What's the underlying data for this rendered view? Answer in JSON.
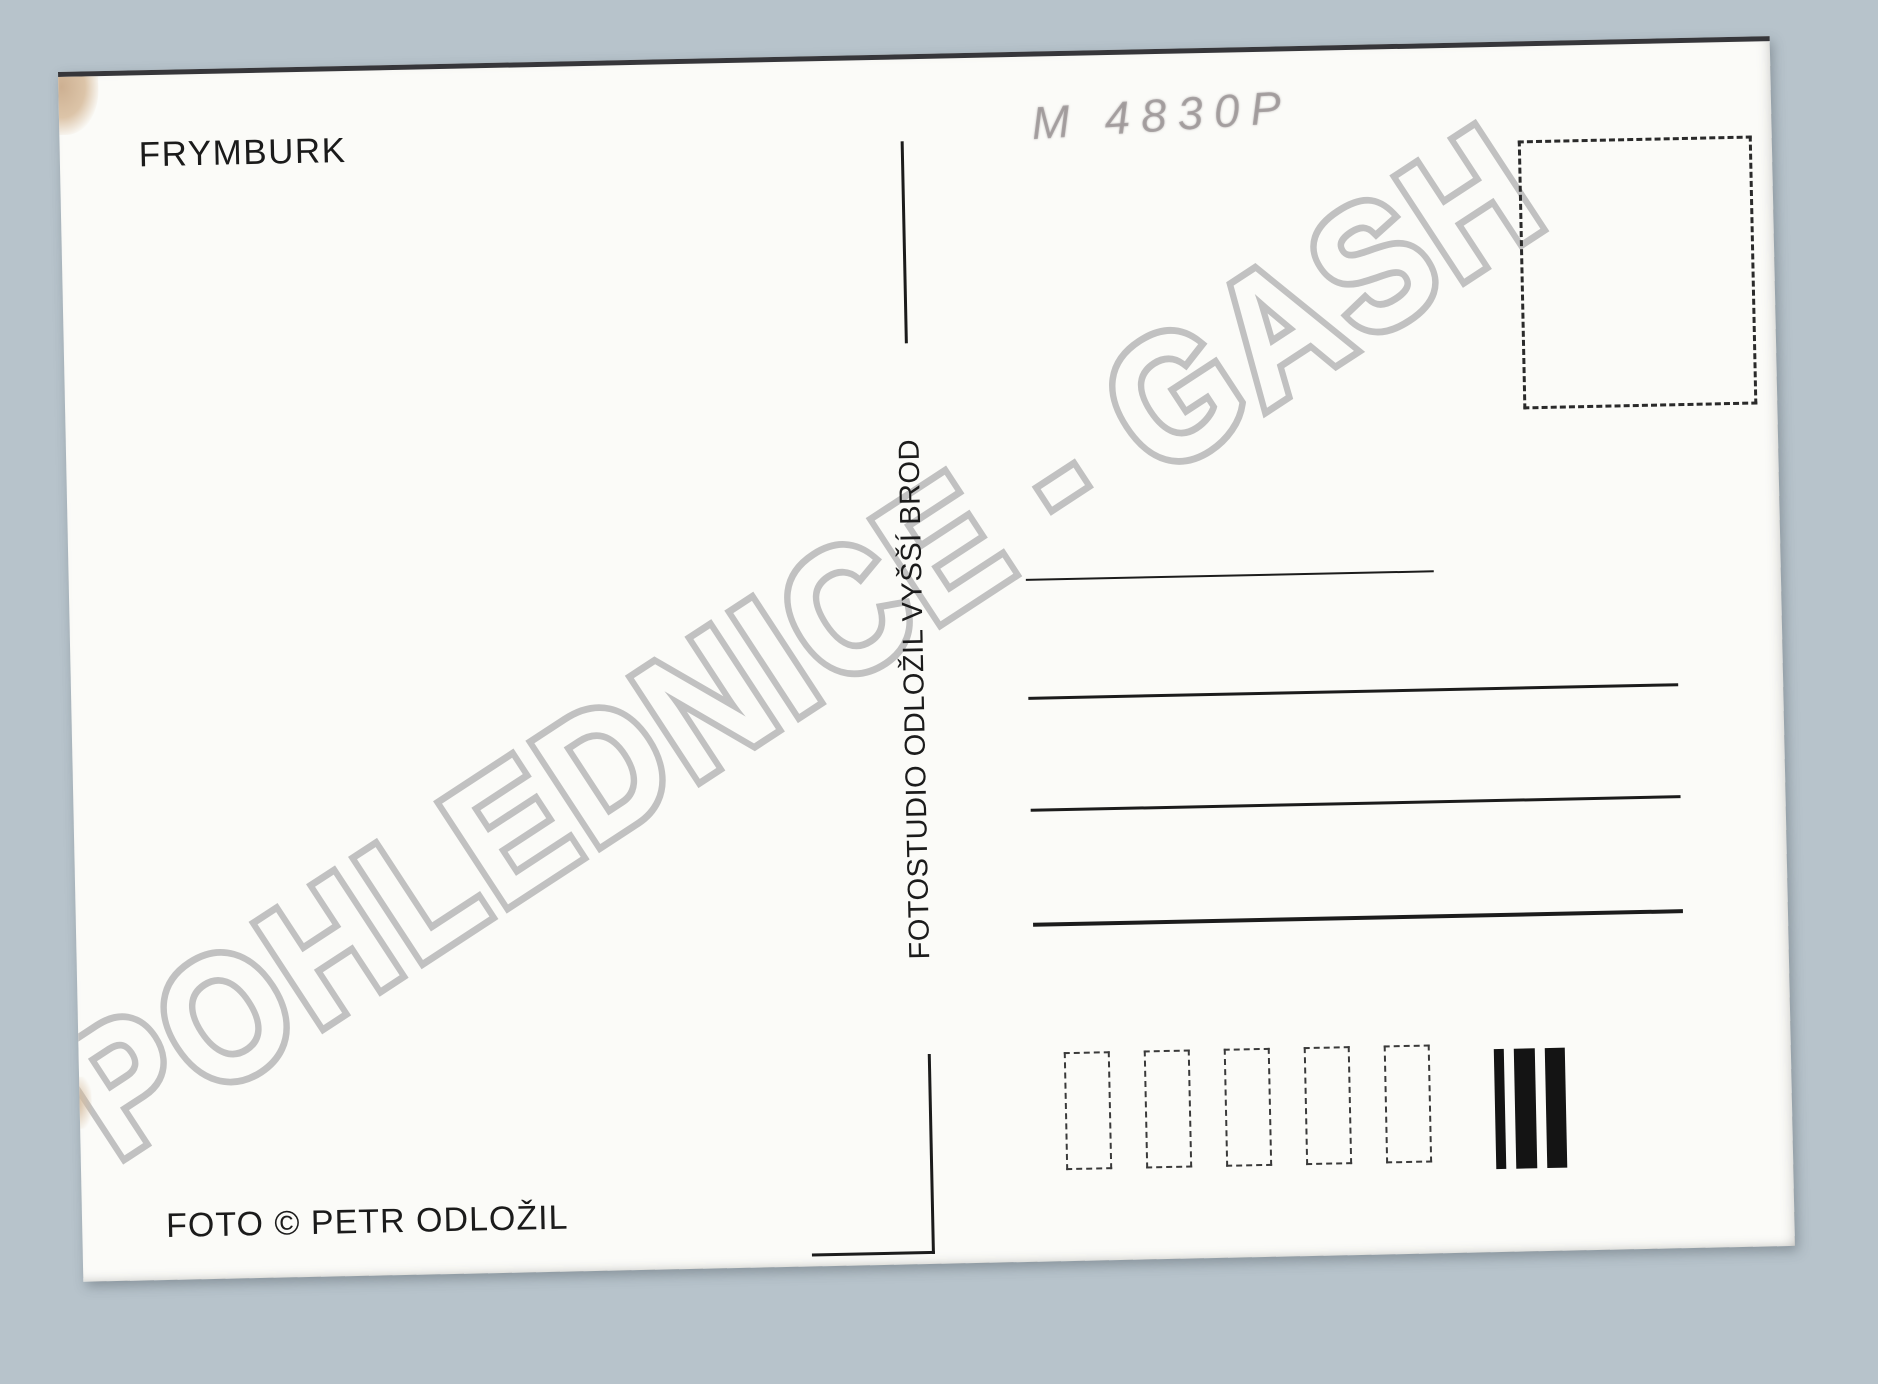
{
  "scan": {
    "background_color": "#b7c3cb",
    "card_color": "#fbfbf8",
    "ink_color": "#1b1b1b"
  },
  "card": {
    "title": "FRYMBURK",
    "pencil_note": "M 4830P",
    "studio_credit_vertical": "FOTOSTUDIO ODLOŽIL VYŠŠÍ BROD",
    "photo_credit": "FOTO © PETR ODLOŽIL",
    "address_lines_count": 4,
    "postal_code_box_count": 5,
    "sorting_bar_count": 3
  },
  "watermark": {
    "text": "POHLEDNICE - GASH",
    "color": "#b3b3b3"
  }
}
